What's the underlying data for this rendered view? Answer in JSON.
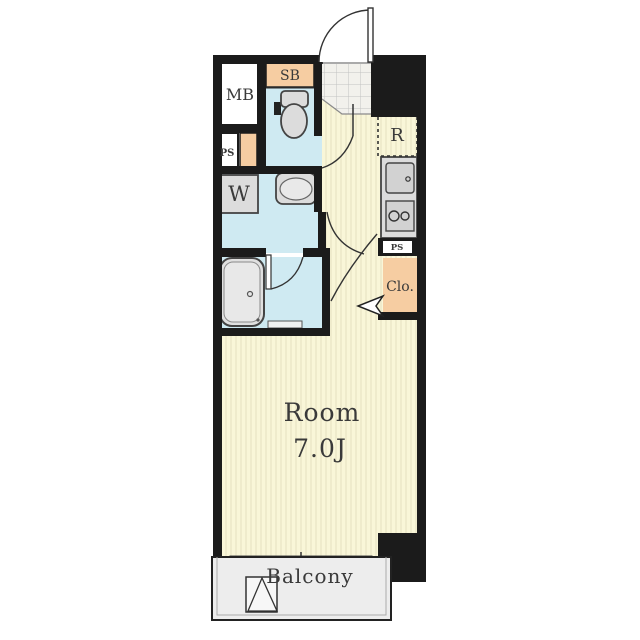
{
  "floorplan": {
    "type": "apartment-floor-plan",
    "labels": {
      "meter_box": "MB",
      "pipe_space_left": "PS",
      "shoe_box": "SB",
      "washing_machine": "W",
      "refrigerator": "R",
      "pipe_space_right": "PS",
      "closet": "Clo.",
      "room": "Room",
      "room_size": "7.0J",
      "balcony": "Balcony"
    },
    "colors": {
      "wall": "#1b1b1b",
      "floor": "#f9f6d8",
      "floor_stripe": "#e9e4c4",
      "wet_area": "#cfeaf2",
      "storage": "#f6cda2",
      "fixture": "#dcdcdc",
      "entry_tile": "#f2f1ec",
      "tile_line": "#c2c2c2",
      "balcony_floor": "#ededed",
      "text": "#3a3a3a",
      "white": "#ffffff"
    }
  }
}
